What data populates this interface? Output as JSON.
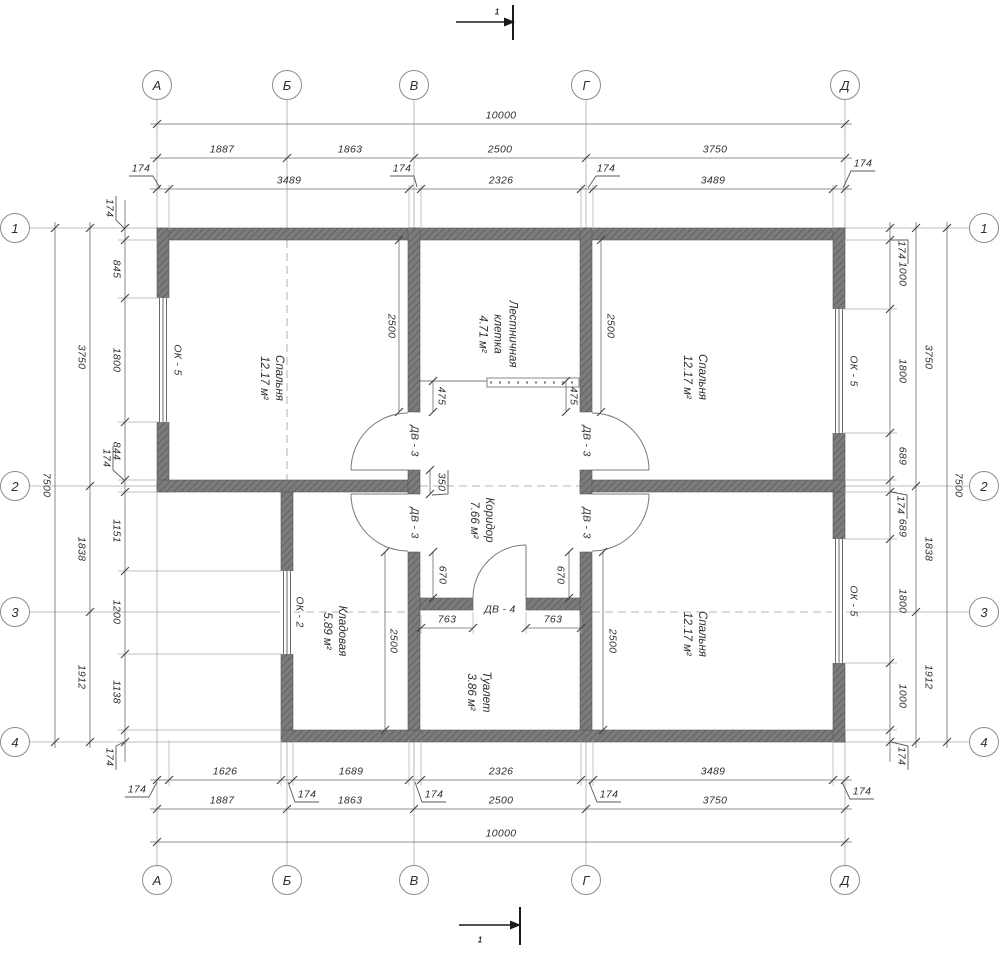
{
  "title": "Floor plan drawing",
  "colors": {
    "ink": "#2f2f2f",
    "dim": "#666666",
    "light": "#aaaaaa",
    "wallBase": "#7b7b7b",
    "wallHatch": "#5f5f5f",
    "paper": "#ffffff"
  },
  "axes": {
    "letters": [
      "А",
      "Б",
      "В",
      "Г",
      "Д"
    ],
    "numbers": [
      "1",
      "2",
      "3",
      "4"
    ]
  },
  "dims": {
    "top_outer": "10000",
    "top_mid": [
      "1887",
      "1863",
      "2500",
      "3750"
    ],
    "top_inner": [
      "3489",
      "2326",
      "3489"
    ],
    "top_wall_ticks": [
      "174",
      "174",
      "174",
      "174"
    ],
    "bottom_inner": [
      "1626",
      "1689",
      "2326",
      "3489"
    ],
    "bottom_wall_ticks": [
      "174",
      "174",
      "174",
      "174",
      "174"
    ],
    "bottom_mid": [
      "1887",
      "1863",
      "2500",
      "3750"
    ],
    "bottom_outer": "10000",
    "left_outer": "7500",
    "left_mid": [
      "3750",
      "1838",
      "1912"
    ],
    "left_inner": [
      "845",
      "1800",
      "844",
      "1151",
      "1200",
      "1138"
    ],
    "left_wall_ticks": [
      "174",
      "174",
      "174"
    ],
    "right_outer": "7500",
    "right_mid": [
      "3750",
      "1838",
      "1912"
    ],
    "right_inner": [
      "1000",
      "1800",
      "689",
      "689",
      "1800",
      "1000"
    ],
    "right_wall_ticks": [
      "174",
      "174",
      "174"
    ],
    "room_depth": [
      "2500",
      "2500",
      "2500",
      "2500"
    ],
    "stair_landing": [
      "475",
      "475"
    ],
    "pier": "350",
    "door_offset": [
      "670",
      "670"
    ],
    "toilet_door": [
      "763",
      "763"
    ]
  },
  "rooms": [
    {
      "id": "bedroom-left",
      "lines": [
        "Спальня",
        "12.17 м²"
      ]
    },
    {
      "id": "staircase",
      "lines": [
        "Лестничная",
        "клетка",
        "4.71 м²"
      ]
    },
    {
      "id": "corridor",
      "lines": [
        "Коридор",
        "7.66 м²"
      ]
    },
    {
      "id": "storage",
      "lines": [
        "Кладовая",
        "5.89 м²"
      ]
    },
    {
      "id": "toilet",
      "lines": [
        "Туалет",
        "3.86 м²"
      ]
    },
    {
      "id": "bedroom-top-right",
      "lines": [
        "Спальня",
        "12.17 м²"
      ]
    },
    {
      "id": "bedroom-bottom-right",
      "lines": [
        "Спальня",
        "12.17 м²"
      ]
    }
  ],
  "windows": [
    {
      "id": "ok5-left",
      "label": "ОК - 5"
    },
    {
      "id": "ok5-right-top",
      "label": "ОК - 5"
    },
    {
      "id": "ok5-right-bottom",
      "label": "ОК - 5"
    },
    {
      "id": "ok2-storage",
      "label": "ОК - 2"
    }
  ],
  "doors": [
    {
      "id": "dv3-upper-left",
      "label": "ДВ - 3"
    },
    {
      "id": "dv3-upper-right",
      "label": "ДВ - 3"
    },
    {
      "id": "dv3-lower-left",
      "label": "ДВ - 3"
    },
    {
      "id": "dv3-lower-right",
      "label": "ДВ - 3"
    },
    {
      "id": "dv4-toilet",
      "label": "ДВ - 4"
    }
  ],
  "section": {
    "label": "1"
  }
}
